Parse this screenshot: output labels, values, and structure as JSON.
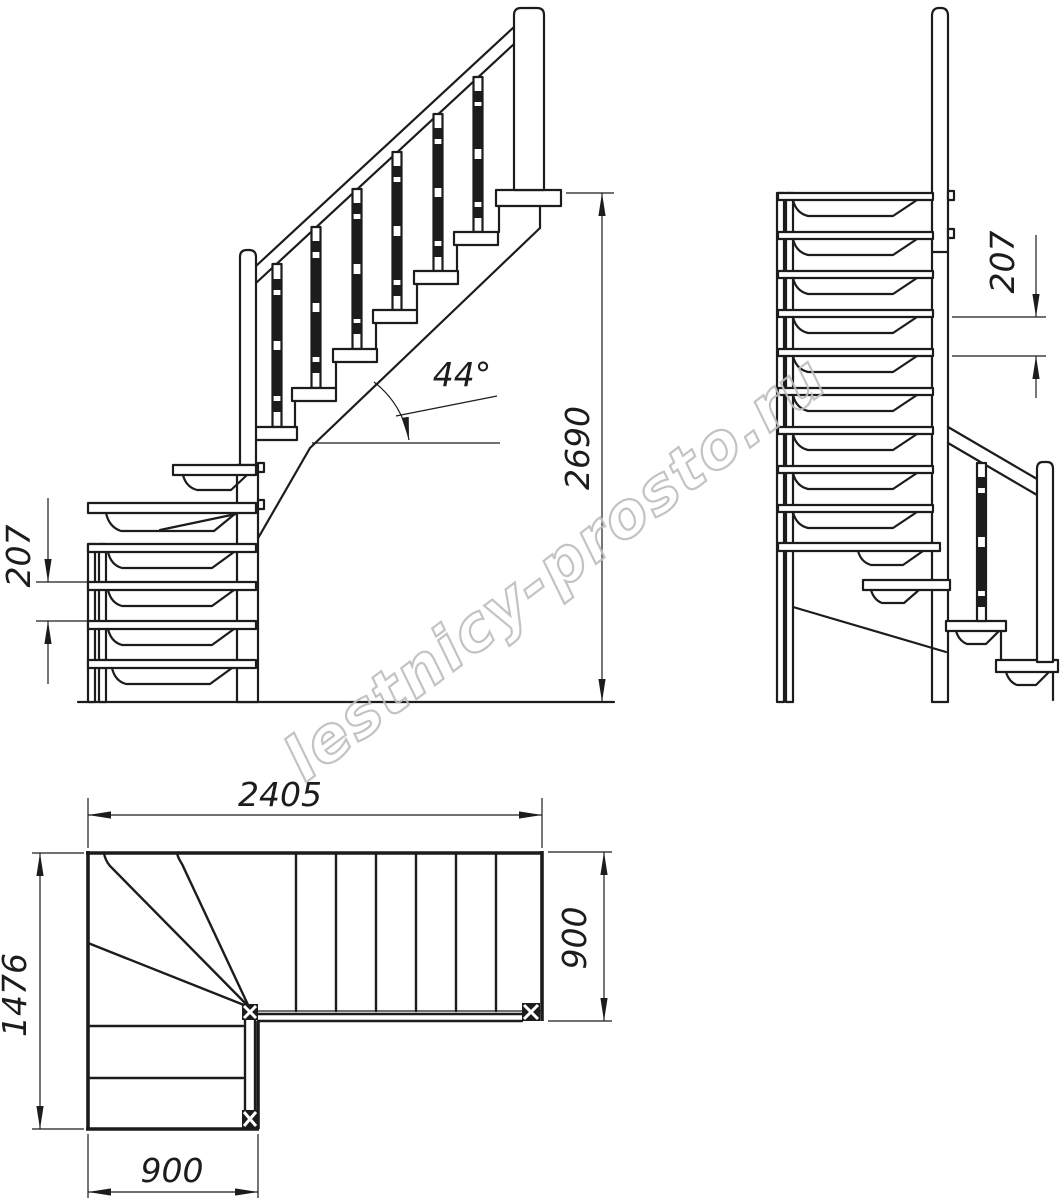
{
  "title": "L-shaped winder staircase technical drawing",
  "watermark": {
    "text": "lestnicy-prosto.ru",
    "color": "#bdbdbd"
  },
  "colors": {
    "line": "#1c1c1c",
    "background": "#ffffff"
  },
  "views": {
    "side": {
      "label": "side elevation",
      "dimensions": {
        "total_height": "2690",
        "step_rise": "207",
        "stair_angle": "44°"
      }
    },
    "front": {
      "label": "front elevation",
      "dimensions": {
        "step_rise": "207"
      }
    },
    "plan": {
      "label": "plan view",
      "dimensions": {
        "total_length": "2405",
        "total_width": "1476",
        "flight_width": "900",
        "lower_flight_width": "900"
      }
    }
  }
}
